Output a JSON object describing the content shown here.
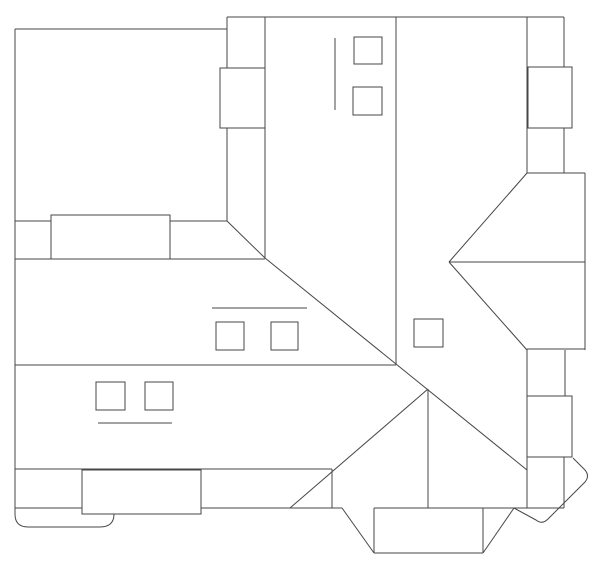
{
  "canvas": {
    "width": 600,
    "height": 569,
    "background": "#ffffff",
    "stroke": "#474747",
    "stroke_width": 1,
    "shape_fill": "#ffffff",
    "description": "Black-and-white architectural roof plan line drawing with dormers, chimneys, skylights, hips and valleys"
  },
  "drawing": {
    "lines": [
      {
        "name": "outline-top-left-edge",
        "x1": 15,
        "y1": 29,
        "x2": 227,
        "y2": 29
      },
      {
        "name": "outline-left-edge",
        "x1": 15,
        "y1": 29,
        "x2": 15,
        "y2": 513
      },
      {
        "name": "outline-top-edge",
        "x1": 227,
        "y1": 17,
        "x2": 564,
        "y2": 17
      },
      {
        "name": "ridge-wall-x227",
        "x1": 227,
        "y1": 17,
        "x2": 227,
        "y2": 221
      },
      {
        "name": "ridge-wall-x265",
        "x1": 265,
        "y1": 17,
        "x2": 265,
        "y2": 258
      },
      {
        "name": "eave-left-y221",
        "x1": 15,
        "y1": 221,
        "x2": 227,
        "y2": 221
      },
      {
        "name": "eave-left-y259",
        "x1": 15,
        "y1": 259,
        "x2": 265,
        "y2": 259
      },
      {
        "name": "valley-diagonal-upper",
        "x1": 227,
        "y1": 221,
        "x2": 265,
        "y2": 258
      },
      {
        "name": "valley-diagonal-main",
        "x1": 265,
        "y1": 258,
        "x2": 527,
        "y2": 470
      },
      {
        "name": "eave-mid-y365",
        "x1": 15,
        "y1": 365,
        "x2": 396,
        "y2": 365
      },
      {
        "name": "ridge-wall-x396",
        "x1": 396,
        "y1": 17,
        "x2": 396,
        "y2": 365
      },
      {
        "name": "right-wing-wall-x527-upper",
        "x1": 527,
        "y1": 17,
        "x2": 527,
        "y2": 173
      },
      {
        "name": "right-wing-wall-x564-upper",
        "x1": 564,
        "y1": 17,
        "x2": 564,
        "y2": 173
      },
      {
        "name": "right-step-y173",
        "x1": 527,
        "y1": 173,
        "x2": 585,
        "y2": 173
      },
      {
        "name": "right-outer-wall-x585",
        "x1": 585,
        "y1": 173,
        "x2": 585,
        "y2": 350
      },
      {
        "name": "hip-right-upper",
        "x1": 527,
        "y1": 173,
        "x2": 449,
        "y2": 262
      },
      {
        "name": "ridge-right-bay",
        "x1": 449,
        "y1": 262,
        "x2": 585,
        "y2": 262
      },
      {
        "name": "hip-right-lower",
        "x1": 449,
        "y1": 262,
        "x2": 527,
        "y2": 350
      },
      {
        "name": "right-step-y349",
        "x1": 527,
        "y1": 349,
        "x2": 585,
        "y2": 349
      },
      {
        "name": "right-wing-wall-x527-lower",
        "x1": 527,
        "y1": 349,
        "x2": 527,
        "y2": 508
      },
      {
        "name": "right-wing-wall-x565-mid",
        "x1": 565,
        "y1": 350,
        "x2": 565,
        "y2": 396
      },
      {
        "name": "right-wing-wall-x564-lower",
        "x1": 564,
        "y1": 457,
        "x2": 564,
        "y2": 508
      },
      {
        "name": "eave-bottom-y469",
        "x1": 15,
        "y1": 469,
        "x2": 332,
        "y2": 469
      },
      {
        "name": "hip-bottom-left",
        "x1": 428,
        "y1": 389,
        "x2": 290,
        "y2": 508
      },
      {
        "name": "valley-post-x332",
        "x1": 332,
        "y1": 469,
        "x2": 332,
        "y2": 508
      },
      {
        "name": "ridge-bottom-x428",
        "x1": 428,
        "y1": 389,
        "x2": 428,
        "y2": 508
      },
      {
        "name": "eave-bottom-left-y508",
        "x1": 15,
        "y1": 508,
        "x2": 342,
        "y2": 508
      },
      {
        "name": "bay-hip-left",
        "x1": 342,
        "y1": 508,
        "x2": 374,
        "y2": 553
      },
      {
        "name": "bay-hip-right",
        "x1": 483,
        "y1": 553,
        "x2": 514,
        "y2": 508
      },
      {
        "name": "bay-eave-y553",
        "x1": 374,
        "y1": 553,
        "x2": 483,
        "y2": 553
      },
      {
        "name": "bay-wall-left-x374",
        "x1": 374,
        "y1": 508,
        "x2": 374,
        "y2": 553
      },
      {
        "name": "bay-wall-right-x483",
        "x1": 483,
        "y1": 508,
        "x2": 483,
        "y2": 553
      },
      {
        "name": "eave-bottom-right-y508",
        "x1": 374,
        "y1": 508,
        "x2": 564,
        "y2": 508
      },
      {
        "name": "detail-tick-vertical-upper",
        "x1": 335,
        "y1": 38,
        "x2": 335,
        "y2": 110
      },
      {
        "name": "detail-tick-middle",
        "x1": 212,
        "y1": 308,
        "x2": 307,
        "y2": 308
      },
      {
        "name": "detail-tick-lower",
        "x1": 98,
        "y1": 423,
        "x2": 172,
        "y2": 423
      }
    ],
    "paths": [
      {
        "name": "rounded-tab-bottom-left",
        "d": "M15,505 L15,514 Q15,527 28,527 L100,527 Q114,527 114,514"
      },
      {
        "name": "rounded-bay-bottom-right",
        "d": "M573,458 L585,470 Q590,476 585,482 L548,519 Q542,525 536,520 L514,508"
      }
    ],
    "rects": [
      {
        "name": "dormer-upper-left",
        "x": 51,
        "y": 215,
        "w": 119,
        "h": 44
      },
      {
        "name": "chimney-upper-center",
        "x": 220,
        "y": 68,
        "w": 45,
        "h": 60
      },
      {
        "name": "chimney-upper-right",
        "x": 528,
        "y": 67,
        "w": 44,
        "h": 61
      },
      {
        "name": "chimney-right",
        "x": 527,
        "y": 396,
        "w": 45,
        "h": 61
      },
      {
        "name": "dormer-lower-left",
        "x": 82,
        "y": 470,
        "w": 119,
        "h": 44
      },
      {
        "name": "skylight-top-1",
        "x": 354,
        "y": 37,
        "w": 28,
        "h": 27
      },
      {
        "name": "skylight-top-2",
        "x": 353,
        "y": 87,
        "w": 29,
        "h": 28
      },
      {
        "name": "skylight-mid-1",
        "x": 216,
        "y": 322,
        "w": 28,
        "h": 28
      },
      {
        "name": "skylight-mid-2",
        "x": 271,
        "y": 322,
        "w": 27,
        "h": 28
      },
      {
        "name": "skylight-low-1",
        "x": 96,
        "y": 382,
        "w": 29,
        "h": 28
      },
      {
        "name": "skylight-low-2",
        "x": 145,
        "y": 382,
        "w": 28,
        "h": 28
      },
      {
        "name": "skylight-center-right",
        "x": 414,
        "y": 319,
        "w": 29,
        "h": 28
      }
    ]
  }
}
